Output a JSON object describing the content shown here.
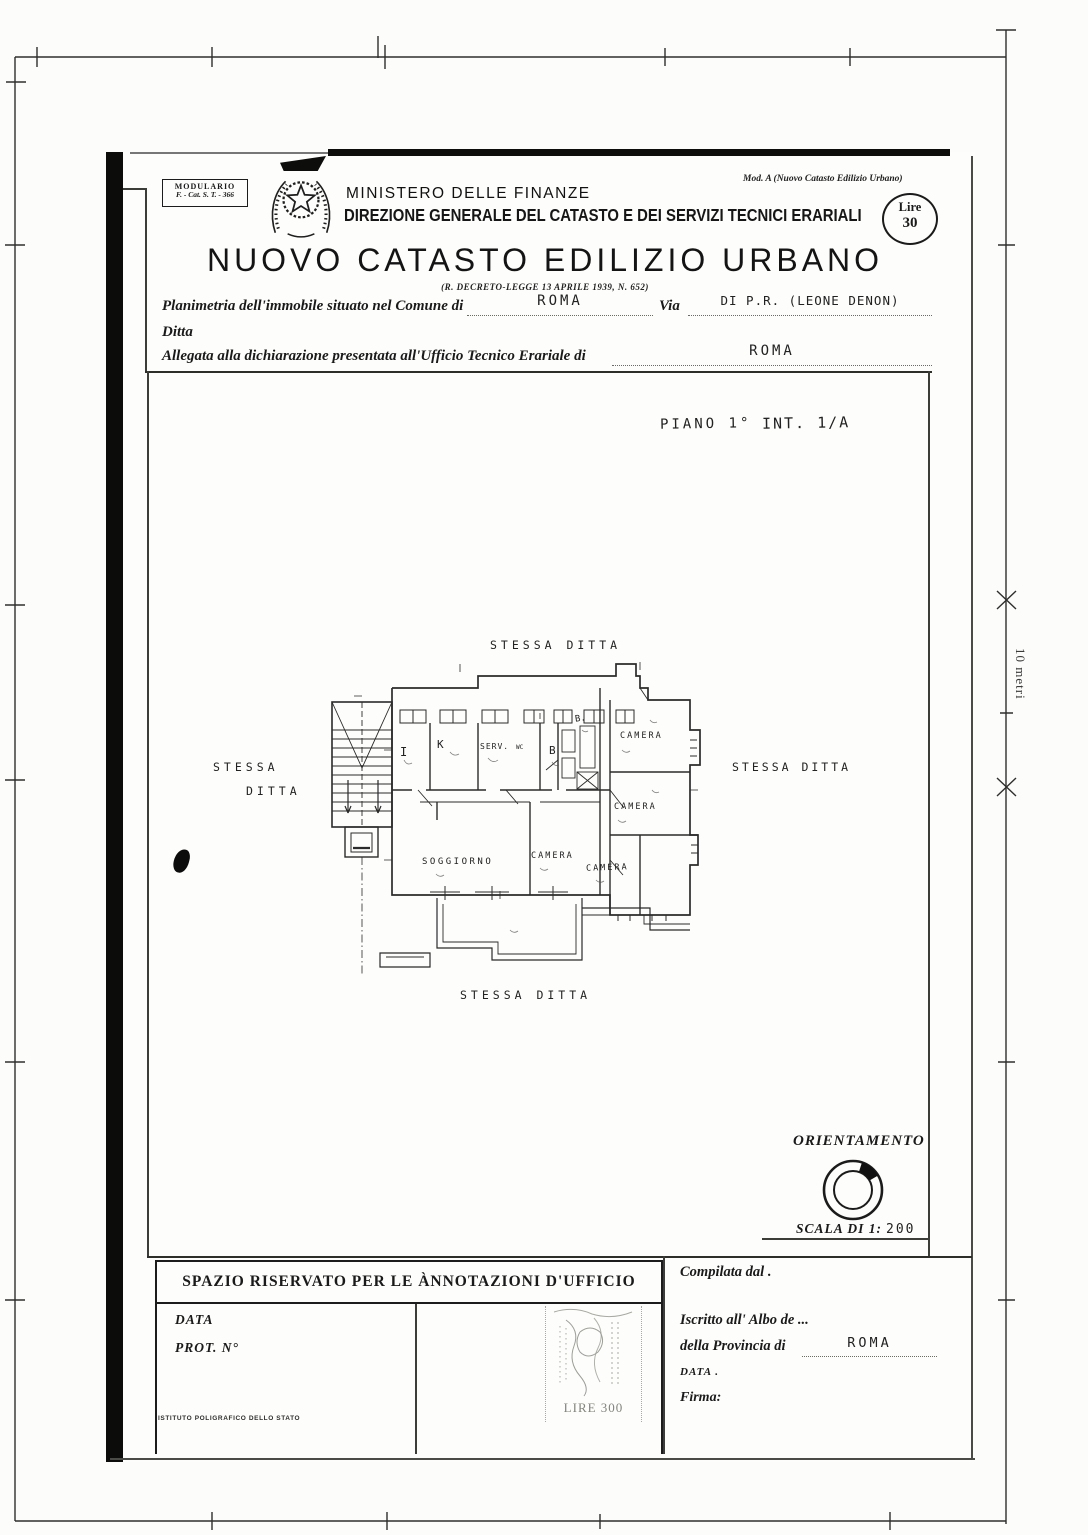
{
  "page": {
    "scale_bar_label": "10 metri"
  },
  "header": {
    "modulario_line1": "MODULARIO",
    "modulario_line2": "F. - Cat. S. T. - 366",
    "ministry": "MINISTERO DELLE FINANZE",
    "directorate": "DIREZIONE GENERALE DEL CATASTO E DEI SERVIZI TECNICI ERARIALI",
    "mod_a_note": "Mod. A (Nuovo Catasto Edilizio Urbano)",
    "stamp_duty_label": "Lire",
    "stamp_duty_value": "30",
    "title": "NUOVO CATASTO EDILIZIO URBANO",
    "decree": "(R. DECRETO-LEGGE 13 APRILE 1939, N. 652)"
  },
  "form": {
    "planimetria_label": "Planimetria dell'immobile situato nel Comune di",
    "comune_value": "ROMA",
    "via_label": "Via",
    "via_value": "DI P.R. (LEONE DENON)",
    "ditta_label": "Ditta",
    "allegata_label": "Allegata alla dichiarazione presentata all'Ufficio Tecnico Erariale di",
    "ufficio_value": "ROMA"
  },
  "plan": {
    "floor": "PIANO 1°",
    "unit": "INT. 1/A",
    "neighbor_top": "STESSA DITTA",
    "neighbor_left_line1": "STESSA",
    "neighbor_left_line2": "DITTA",
    "neighbor_right": "STESSA DITTA",
    "neighbor_bottom": "STESSA DITTA",
    "rooms": {
      "ingresso": "I",
      "cucina": "K",
      "servizio": "SERV.",
      "wc": "WC",
      "bagno": "B",
      "bagno_piccolo": "B.",
      "camera_1": "CAMERA",
      "camera_2": "CAMERA",
      "camera_3": "CAMERA",
      "camera_4": "CAMERA",
      "soggiorno": "SOGGIORNO"
    }
  },
  "orientation": {
    "label": "ORIENTAMENTO",
    "scale_label": "SCALA DI 1:",
    "scale_value": "200"
  },
  "annotations": {
    "header": "SPAZIO RISERVATO PER LE ÀNNOTAZIONI D'UFFICIO",
    "data_label": "DATA",
    "prot_label": "PROT. N°",
    "stamp_value": "LIRE 300"
  },
  "compiler": {
    "compilata_label": "Compilata dal .",
    "iscritto_label": "Iscritto all' Albo de ...",
    "provincia_label": "della Provincia di",
    "provincia_value": "ROMA",
    "data_label": "DATA .",
    "firma_label": "Firma:"
  },
  "printer": "ISTITUTO POLIGRAFICO DELLO STATO"
}
